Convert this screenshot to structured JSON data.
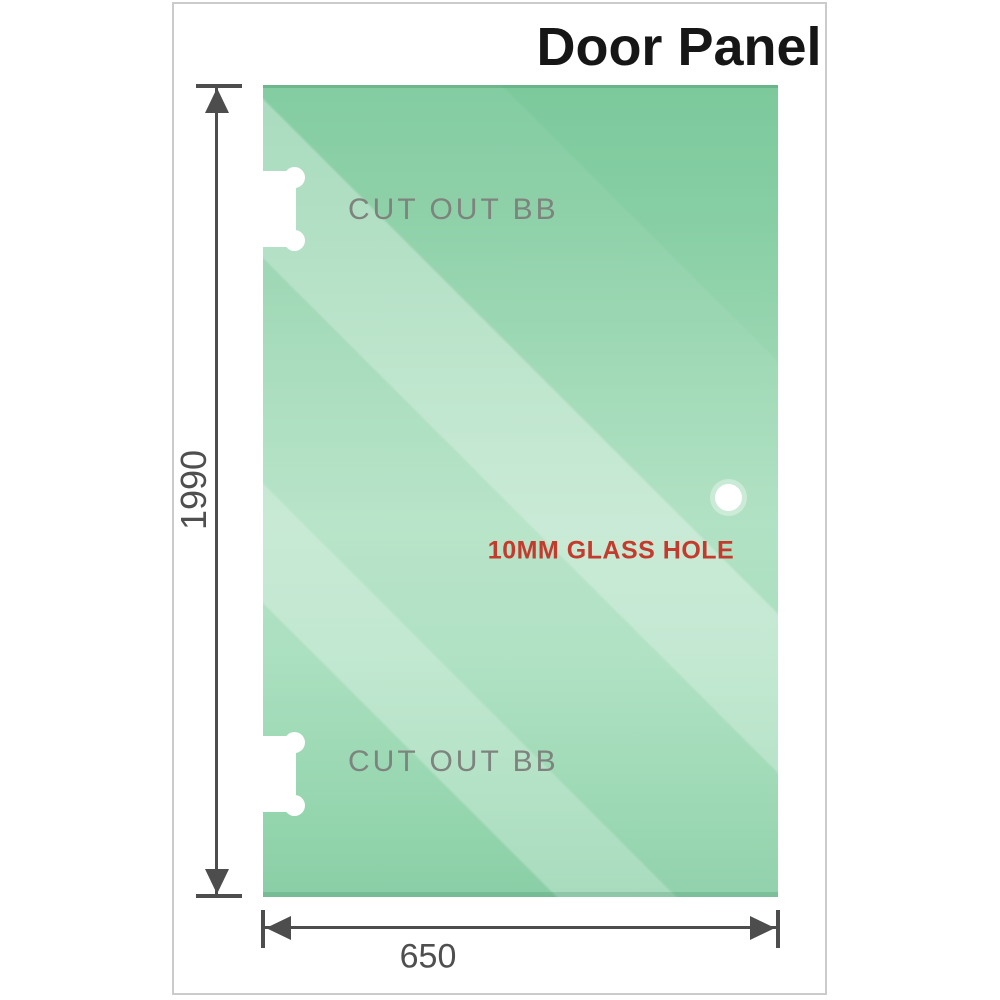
{
  "title": "Door Panel",
  "panel": {
    "cutout_top_label": "CUT OUT BB",
    "cutout_bottom_label": "CUT OUT BB",
    "hole_label": "10MM GLASS HOLE"
  },
  "dimensions": {
    "height_mm": "1990",
    "width_mm": "650"
  },
  "colors": {
    "glass_green_top": "#82cda2",
    "glass_green_light": "#c8ebd5",
    "glass_green_bottom": "#a5dcbc",
    "hole_label_red": "#c43b2e",
    "dimension_gray": "#4d4d4d",
    "cutout_label_gray": "#7e837e",
    "frame_border_gray": "#cbcbcb"
  }
}
